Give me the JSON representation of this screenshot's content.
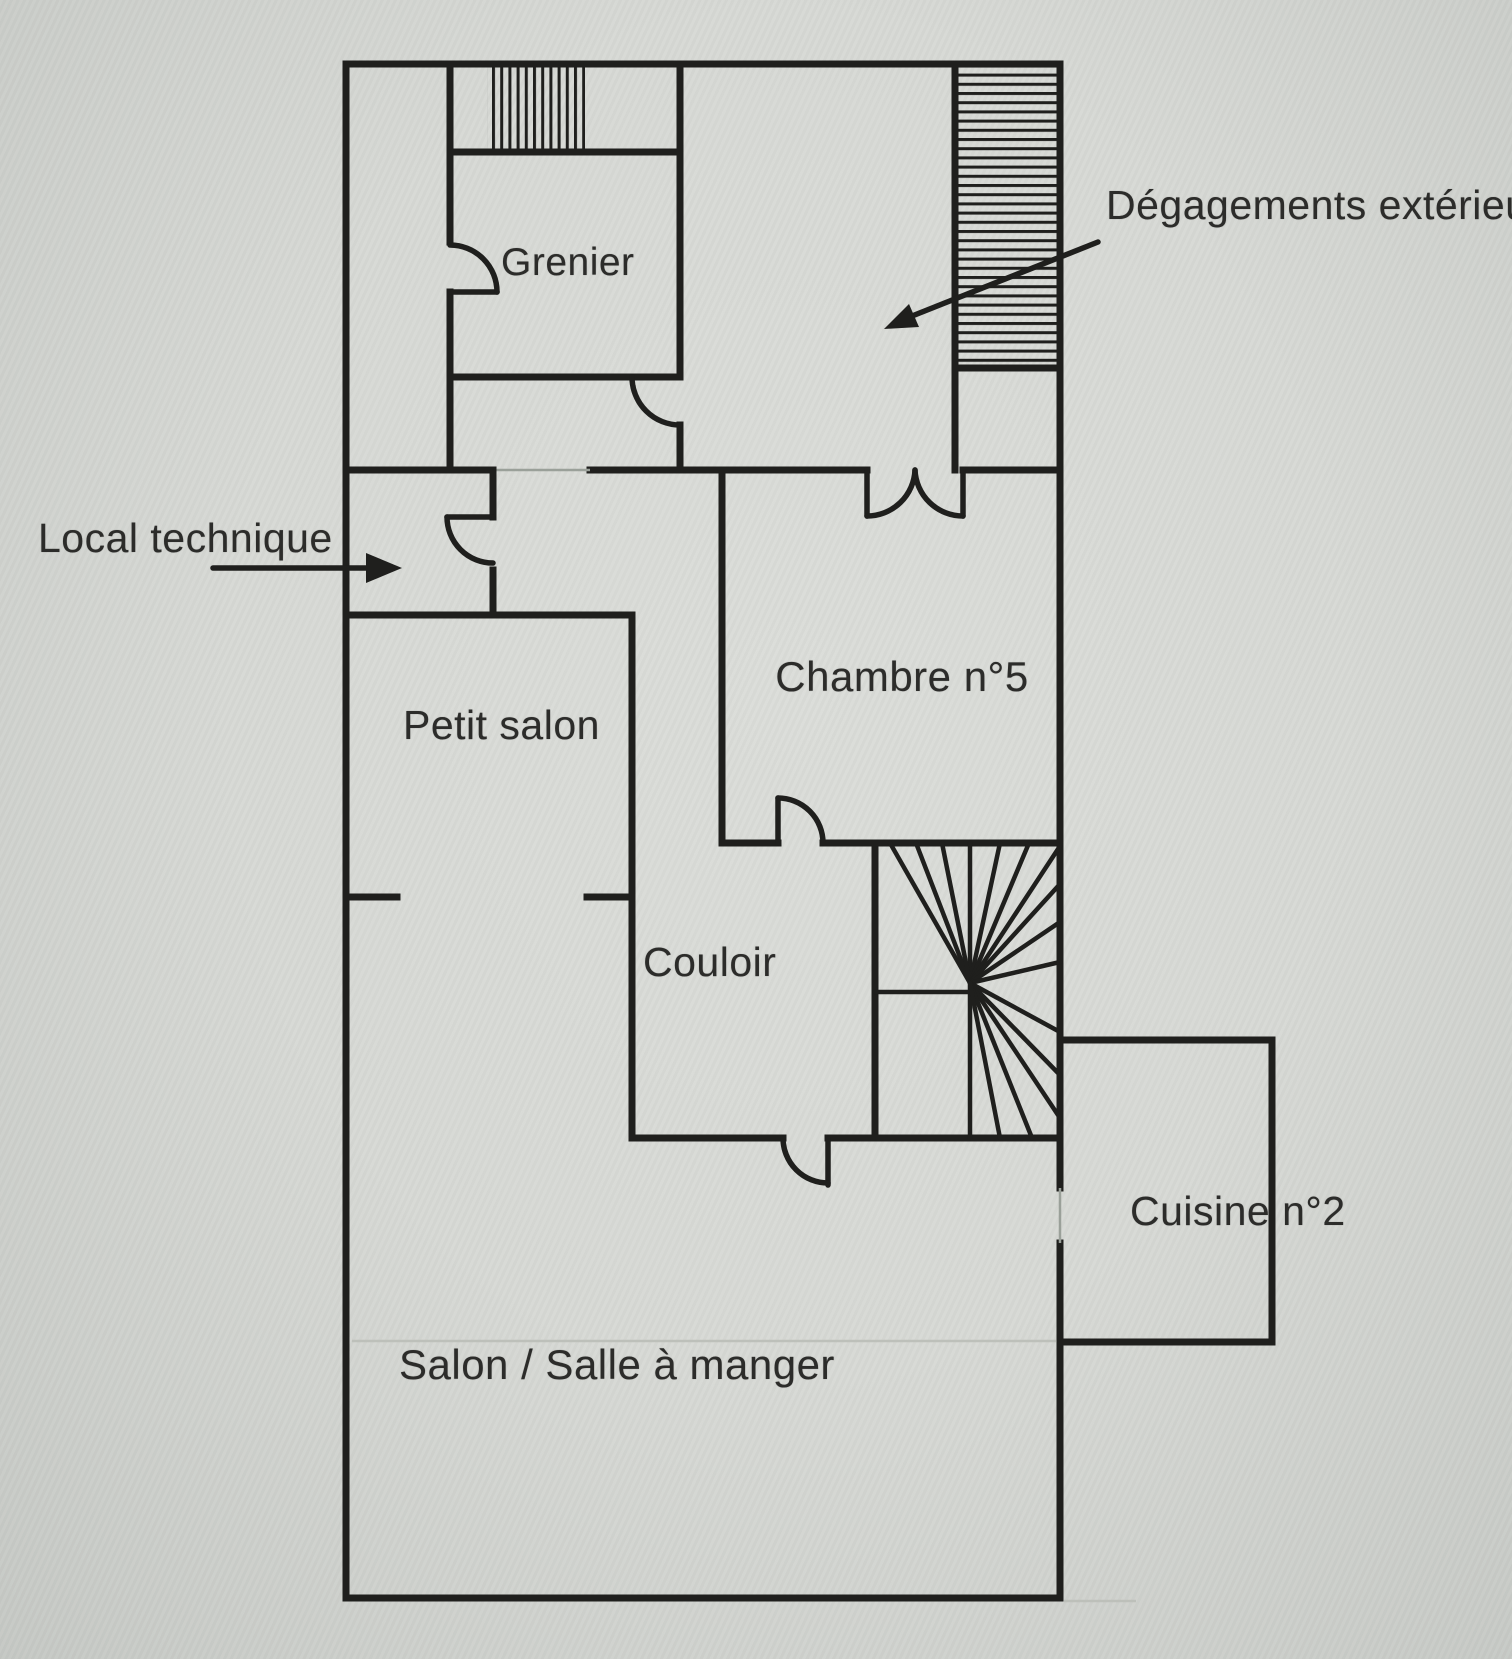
{
  "rooms": {
    "grenier": {
      "label": "Grenier"
    },
    "chambre5": {
      "label": "Chambre n°5"
    },
    "petit_salon": {
      "label": "Petit salon"
    },
    "couloir": {
      "label": "Couloir"
    },
    "cuisine": {
      "label": "Cuisine n°2"
    },
    "salon": {
      "label": "Salon / Salle à manger"
    }
  },
  "annotations": {
    "exterior_access": {
      "label": "Dégagements extérieur",
      "arrow": "points-down-left-into-hatched-exterior-stair-room"
    },
    "technical_room": {
      "label": "Local technique",
      "arrow": "points-right-into-technical-room"
    }
  },
  "symbols": {
    "grenier_stair_hatch": "vertical-hatched-stair-strip-top-left",
    "exterior_stair_hatch": "horizontal-hatched-exterior-stair-strip-top-right",
    "winder_stair": "quarter-turn-winder-staircase-fan",
    "door_arcs": "single-leaf-door-swing-arcs",
    "double_door": "double-leaf-door-between-upper-room-and-bedroom"
  },
  "colors": {
    "paper": "#d7d9d5",
    "ink": "#1f1f1d",
    "label_text": "#2c2c2a",
    "faint": "#bdc0ba",
    "thin": "#9aa099"
  }
}
